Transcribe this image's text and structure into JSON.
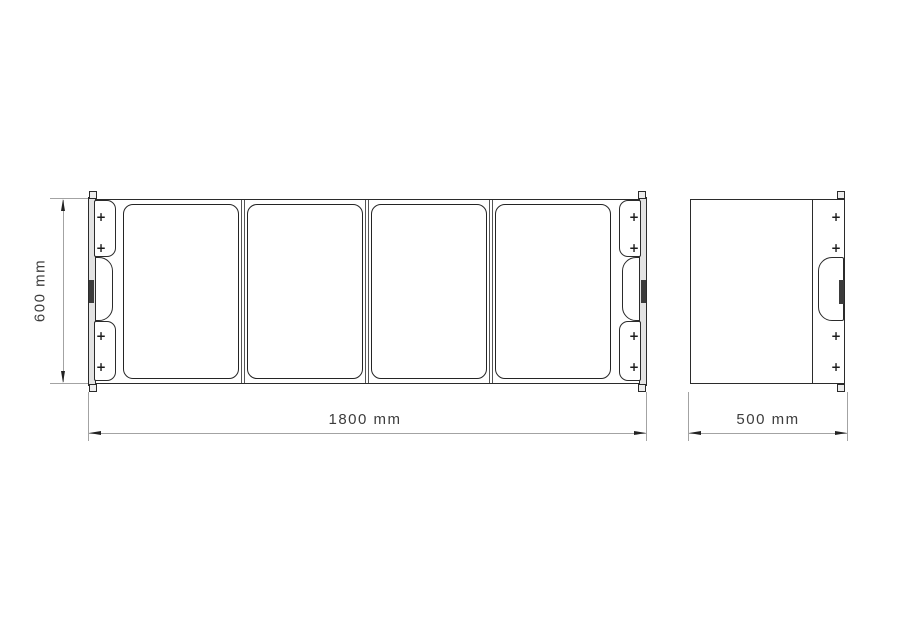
{
  "glyphs": {
    "plus": "+"
  },
  "dimensions": {
    "front_height": "600 mm",
    "front_width": "1800 mm",
    "side_width": "500 mm"
  },
  "front_view": {
    "panel_count": 4,
    "snap_mark_count": 8
  },
  "side_view": {
    "snap_mark_count": 4
  },
  "colors": {
    "background": "#ffffff",
    "outline": "#2b2b2b",
    "dimension_line": "#a3a3a3",
    "dimension_text": "#3d3d3d",
    "strip_fill": "#e3e3e3",
    "brand_label": "#3b3b3b"
  }
}
